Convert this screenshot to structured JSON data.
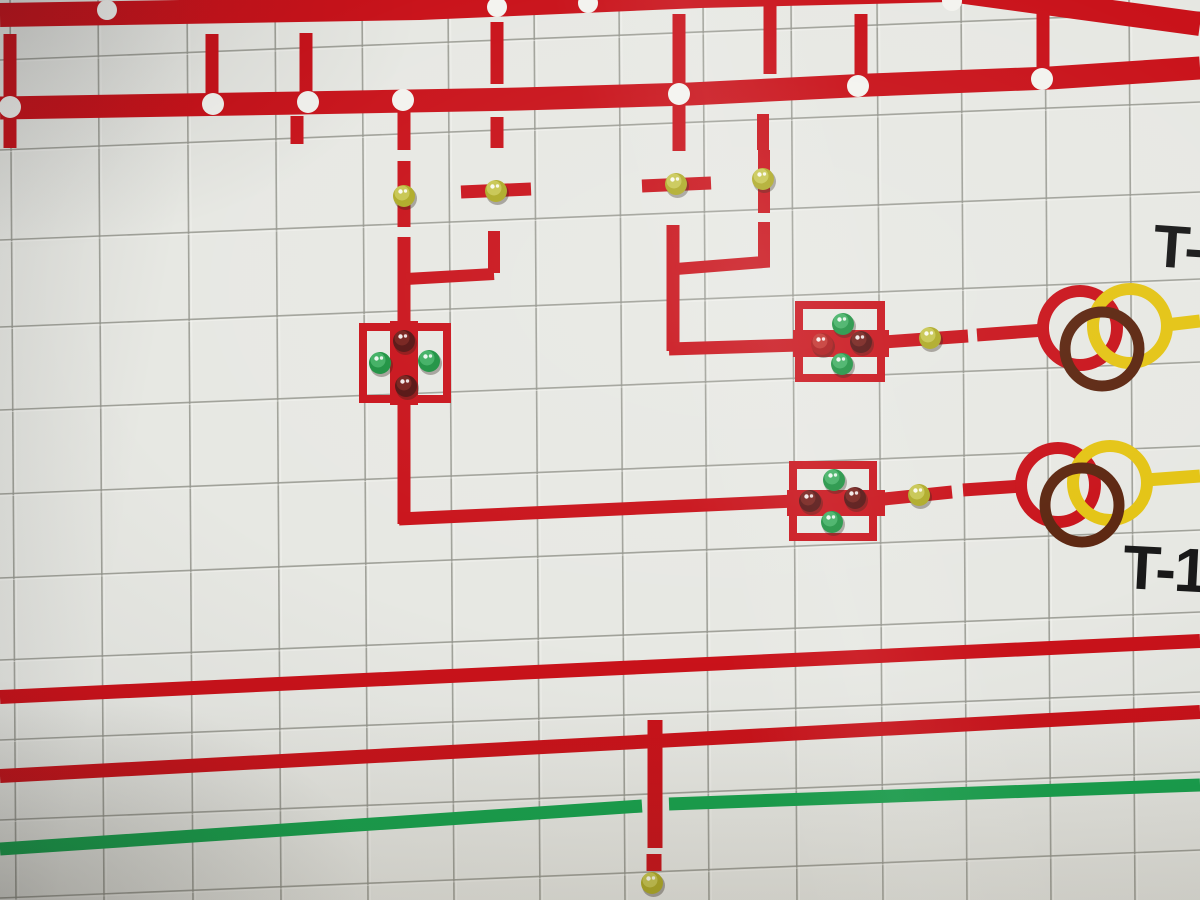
{
  "labels": {
    "transformer1": "T-",
    "transformer2": "T-1"
  },
  "palette": {
    "red_line": "#c9121a",
    "green_line": "#16a24d",
    "yellow_line": "#e4c414",
    "brown_ring": "#5c2610",
    "tile": "#e7e8e3",
    "joint": "#95968e",
    "text": "#191919",
    "dot_white": "#f3f3ef"
  },
  "led_colors": {
    "yellow": {
      "base": "#aeaa26",
      "hi": "#dcdd72"
    },
    "green": {
      "base": "#1c9140",
      "hi": "#5cc97e"
    },
    "darkred": {
      "base": "#551110",
      "hi": "#8f2b22"
    },
    "red": {
      "base": "#ab1517",
      "hi": "#d84b42"
    }
  },
  "leds": [
    {
      "name": "feeder1-line-lamp",
      "color": "yellow",
      "x": 404,
      "y": 196
    },
    {
      "name": "feeder1-branch-lamp",
      "color": "yellow",
      "x": 496,
      "y": 191
    },
    {
      "name": "feeder2-line-lamp",
      "color": "yellow",
      "x": 676,
      "y": 184
    },
    {
      "name": "feeder2-branch-lamp",
      "color": "yellow",
      "x": 763,
      "y": 179
    },
    {
      "name": "breaker1-top-lamp",
      "color": "darkred",
      "x": 404,
      "y": 341
    },
    {
      "name": "breaker1-left-lamp",
      "color": "green",
      "x": 380,
      "y": 363
    },
    {
      "name": "breaker1-right-lamp",
      "color": "green",
      "x": 429,
      "y": 361
    },
    {
      "name": "breaker1-bottom-lamp",
      "color": "darkred",
      "x": 406,
      "y": 386
    },
    {
      "name": "breaker2-top-lamp",
      "color": "green",
      "x": 843,
      "y": 324
    },
    {
      "name": "breaker2-left-lamp",
      "color": "red",
      "x": 822,
      "y": 344
    },
    {
      "name": "breaker2-right-lamp",
      "color": "darkred",
      "x": 861,
      "y": 342
    },
    {
      "name": "breaker2-bottom-lamp",
      "color": "green",
      "x": 842,
      "y": 364
    },
    {
      "name": "t1-feed-lamp",
      "color": "yellow",
      "x": 930,
      "y": 338
    },
    {
      "name": "breaker3-top-lamp",
      "color": "green",
      "x": 834,
      "y": 480
    },
    {
      "name": "breaker3-left-lamp",
      "color": "darkred",
      "x": 810,
      "y": 501
    },
    {
      "name": "breaker3-right-lamp",
      "color": "darkred",
      "x": 855,
      "y": 498
    },
    {
      "name": "breaker3-bottom-lamp",
      "color": "green",
      "x": 832,
      "y": 522
    },
    {
      "name": "t2-feed-lamp",
      "color": "yellow",
      "x": 919,
      "y": 495
    },
    {
      "name": "bottom-feeder-lamp",
      "color": "yellow",
      "x": 652,
      "y": 883
    }
  ],
  "bus_dots": {
    "top_bus": [
      [
        107,
        10
      ],
      [
        497,
        7
      ],
      [
        588,
        3
      ],
      [
        952,
        1
      ]
    ],
    "second_bus": [
      [
        10,
        107
      ],
      [
        213,
        104
      ],
      [
        308,
        102
      ],
      [
        403,
        100
      ],
      [
        679,
        94
      ],
      [
        858,
        86
      ],
      [
        1042,
        79
      ]
    ]
  }
}
